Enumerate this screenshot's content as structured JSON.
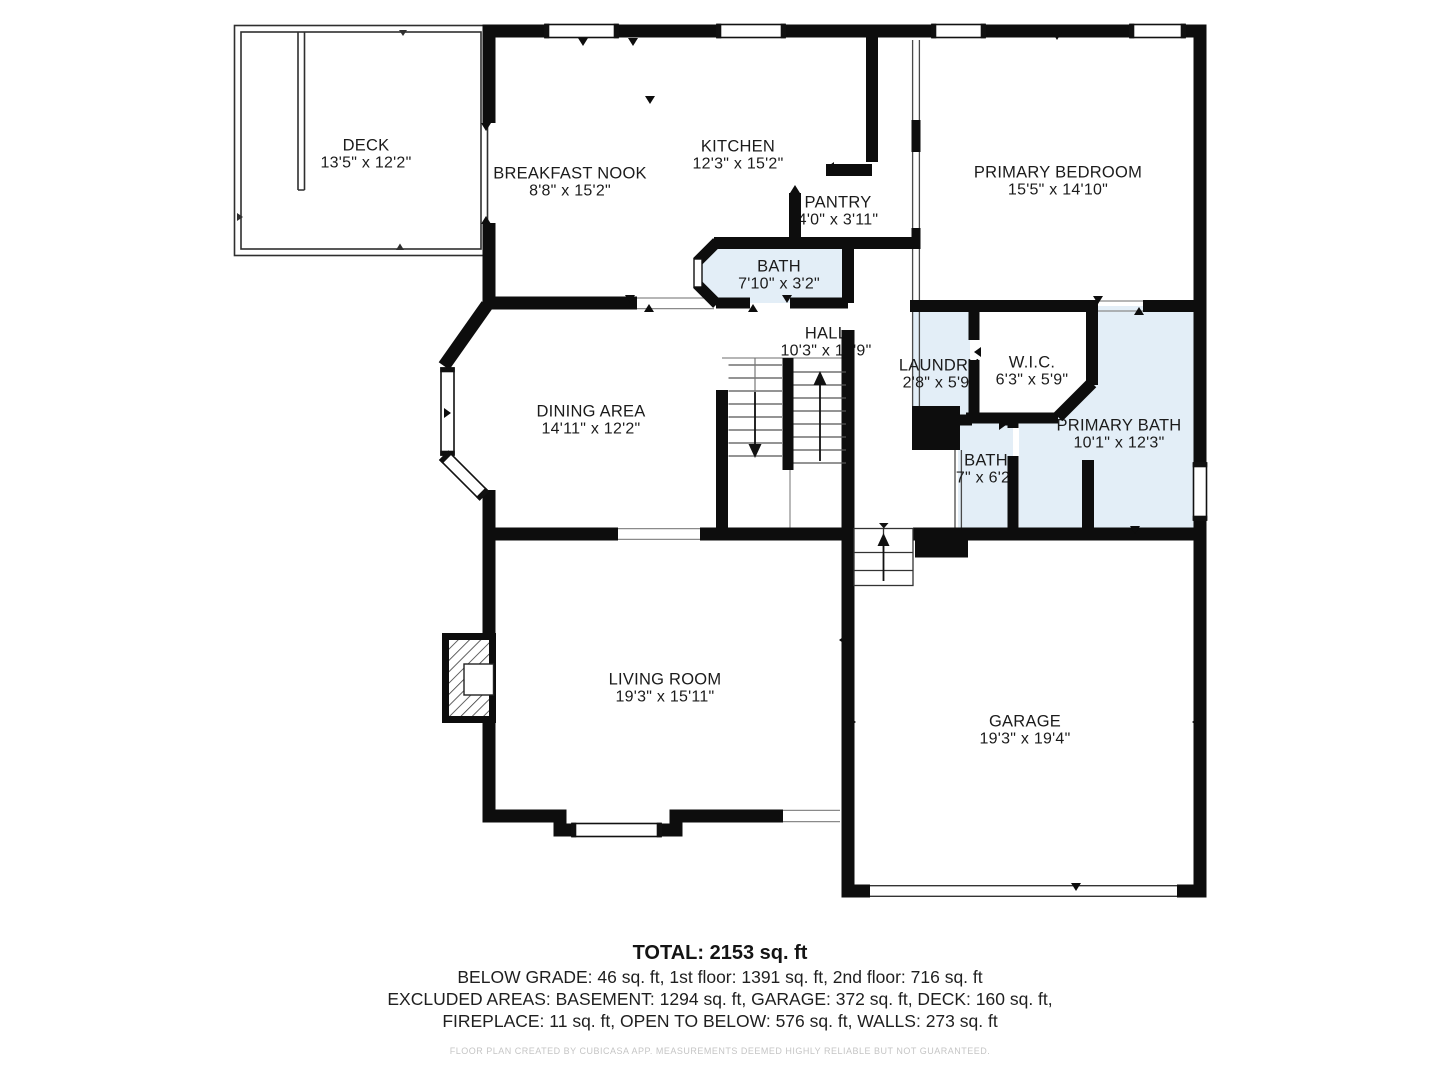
{
  "plan": {
    "rooms": [
      {
        "id": "deck",
        "name": "DECK",
        "dims": "13'5\" x 12'2\""
      },
      {
        "id": "breakfast-nook",
        "name": "BREAKFAST NOOK",
        "dims": "8'8\" x 15'2\""
      },
      {
        "id": "kitchen",
        "name": "KITCHEN",
        "dims": "12'3\" x 15'2\""
      },
      {
        "id": "pantry",
        "name": "PANTRY",
        "dims": "4'0\" x 3'11\""
      },
      {
        "id": "primary-bedroom",
        "name": "PRIMARY BEDROOM",
        "dims": "15'5\" x 14'10\""
      },
      {
        "id": "bath",
        "name": "BATH",
        "dims": "7'10\" x 3'2\""
      },
      {
        "id": "hall",
        "name": "HALL",
        "dims": "10'3\" x 15'9\""
      },
      {
        "id": "laundry",
        "name": "LAUNDRY",
        "dims": "2'8\" x 5'9\""
      },
      {
        "id": "wic",
        "name": "W.I.C.",
        "dims": "6'3\" x 5'9\""
      },
      {
        "id": "primary-bath",
        "name": "PRIMARY BATH",
        "dims": "10'1\" x 12'3\""
      },
      {
        "id": "dining-area",
        "name": "DINING AREA",
        "dims": "14'11\" x 12'2\""
      },
      {
        "id": "bath-2",
        "name": "BATH",
        "dims": "7\" x 6'2\""
      },
      {
        "id": "living-room",
        "name": "LIVING ROOM",
        "dims": "19'3\" x 15'11\""
      },
      {
        "id": "garage",
        "name": "GARAGE",
        "dims": "19'3\" x 19'4\""
      }
    ]
  },
  "summary": {
    "total": "TOTAL: 2153 sq. ft",
    "line1": "BELOW GRADE: 46 sq. ft, 1st floor: 1391 sq. ft, 2nd floor: 716 sq. ft",
    "line2": "EXCLUDED AREAS: BASEMENT: 1294 sq. ft, GARAGE: 372 sq. ft, DECK: 160 sq. ft,",
    "line3": "FIREPLACE: 11 sq. ft, OPEN TO BELOW: 576 sq. ft, WALLS: 273 sq. ft"
  },
  "footer": "FLOOR PLAN CREATED BY CUBICASA APP. MEASUREMENTS DEEMED HIGHLY RELIABLE BUT NOT GUARANTEED.",
  "colors": {
    "wall": "#0d0d0d",
    "wet_room_fill": "#e3eef7",
    "text": "#1b1b1b",
    "footer_text": "#c5c5c5"
  }
}
